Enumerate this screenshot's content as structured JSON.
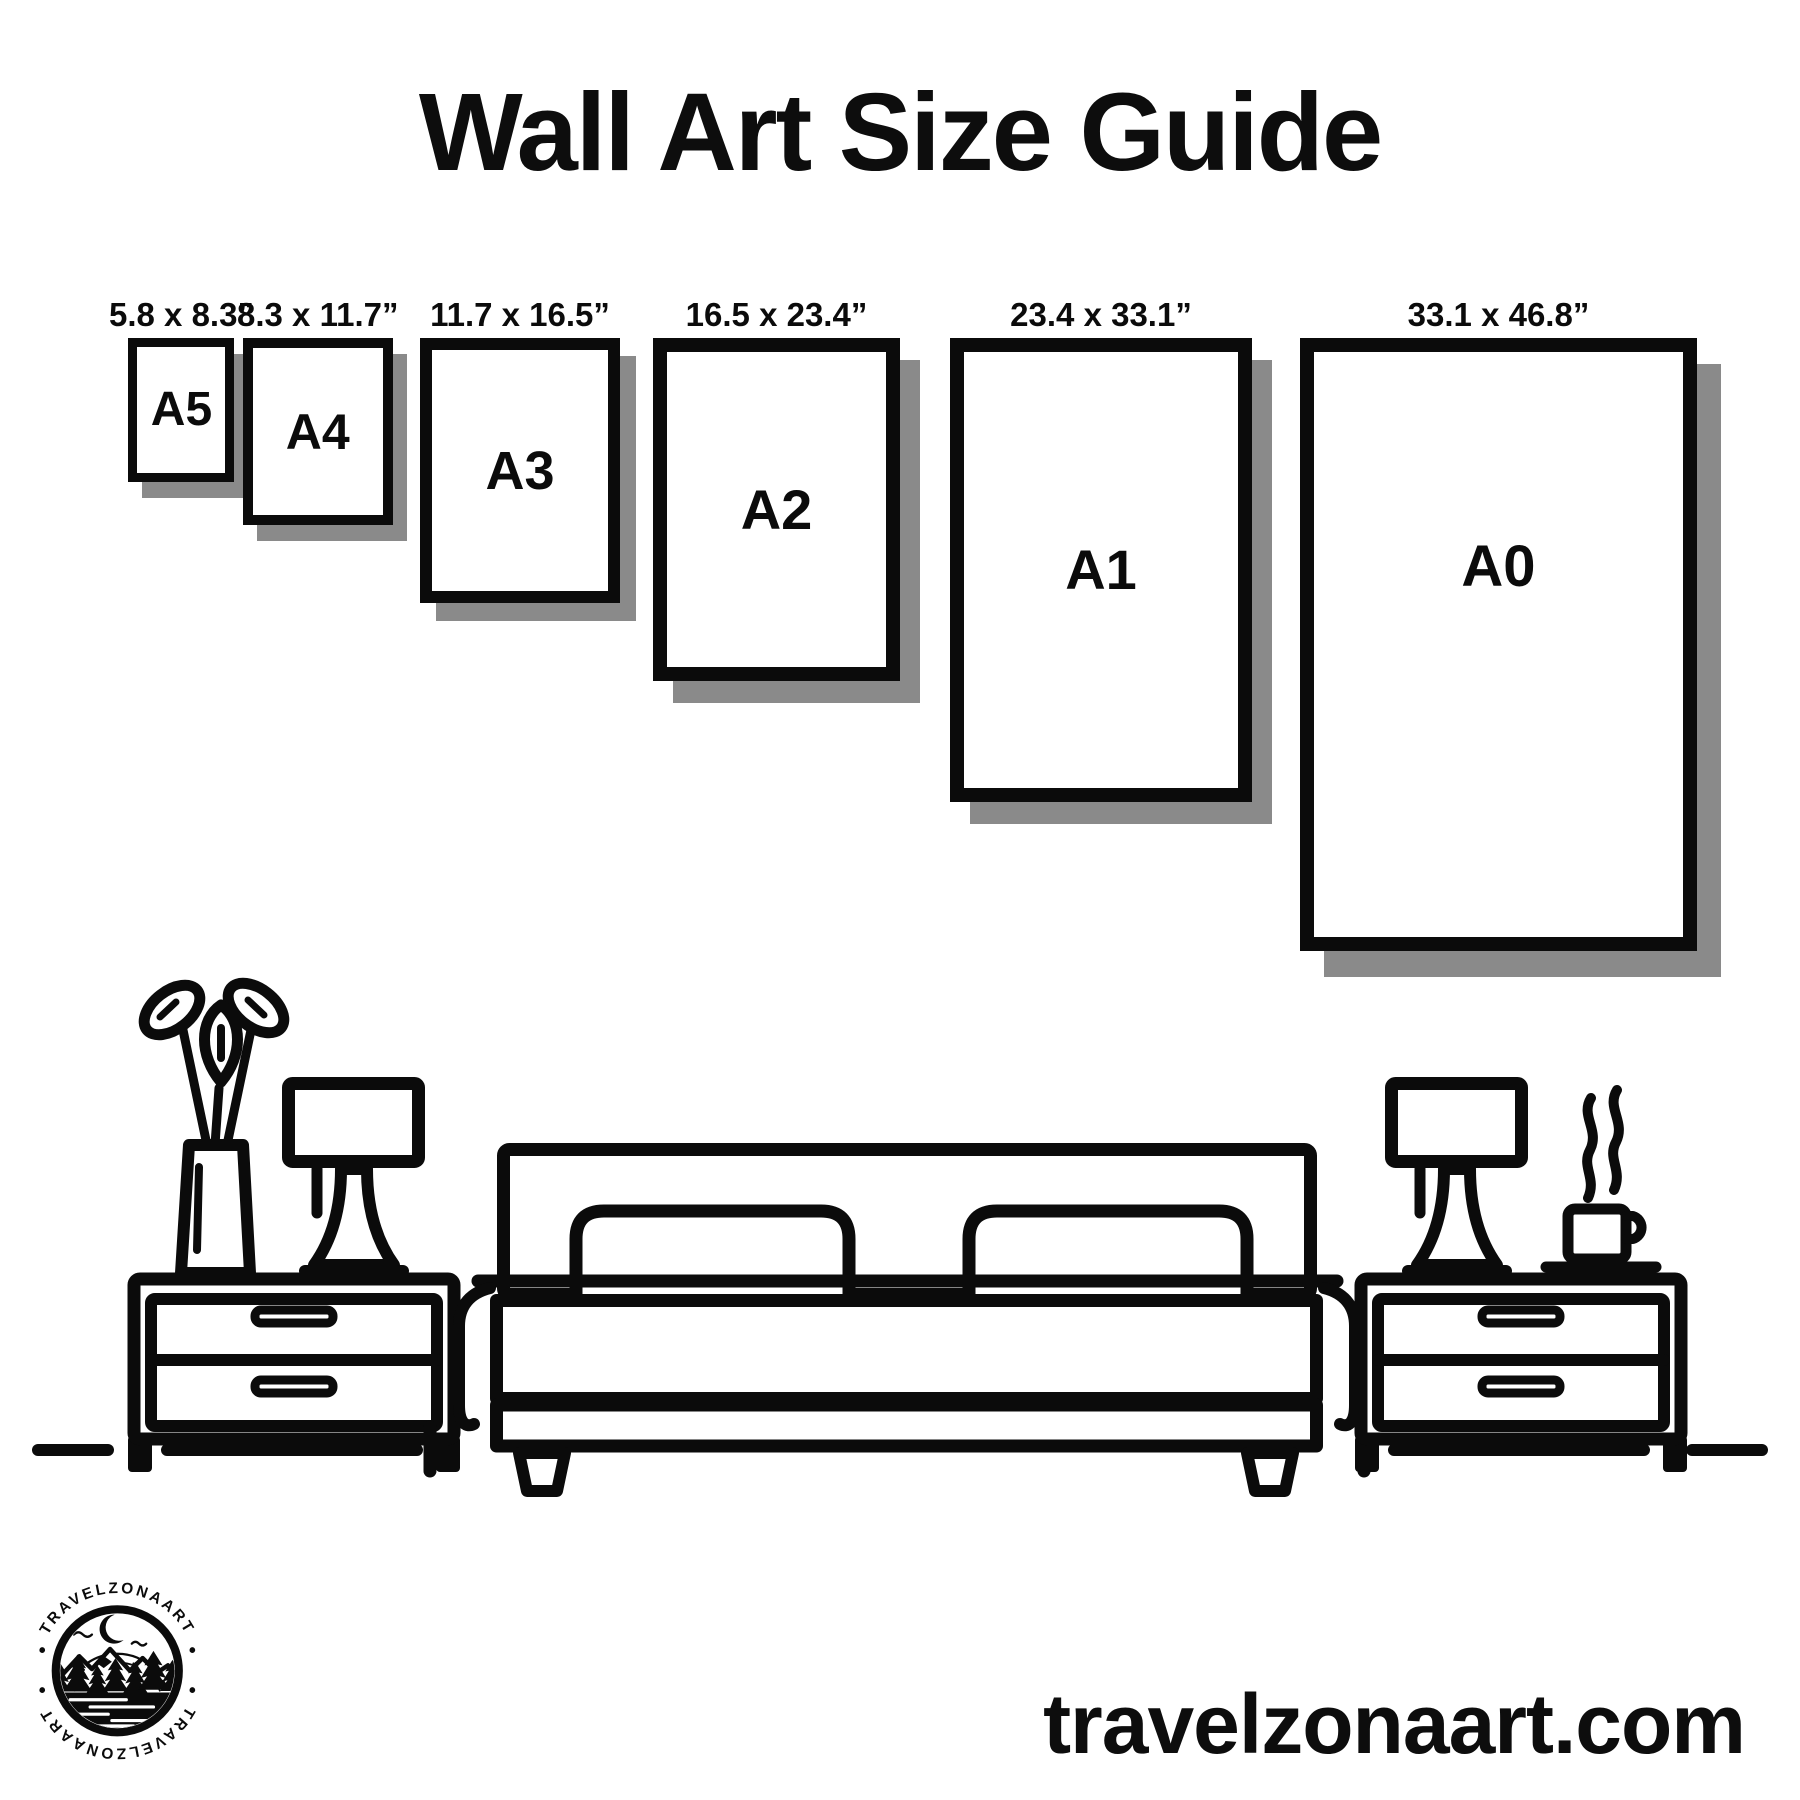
{
  "page": {
    "title": "Wall Art Size Guide",
    "website": "travelzonaart.com"
  },
  "colors": {
    "ink": "#0b0b0b",
    "shadow": "#8a8a8a",
    "paper": "#ffffff"
  },
  "sizes": [
    {
      "code": "A5",
      "dimensions": "5.8 x 8.3”"
    },
    {
      "code": "A4",
      "dimensions": "8.3 x 11.7”"
    },
    {
      "code": "A3",
      "dimensions": "11.7 x 16.5”"
    },
    {
      "code": "A2",
      "dimensions": "16.5 x 23.4”"
    },
    {
      "code": "A1",
      "dimensions": "23.4 x 33.1”"
    },
    {
      "code": "A0",
      "dimensions": "33.1 x 46.8”"
    }
  ],
  "logo": {
    "arc_text_top": "TRAVELZONAART",
    "arc_text_bottom": "TRAVELZONAART",
    "separator": "•"
  },
  "scene": {
    "items": [
      "potted-plant",
      "table-lamp",
      "nightstand",
      "double-bed",
      "pillows",
      "steaming-coffee-cup",
      "floor-line"
    ]
  }
}
